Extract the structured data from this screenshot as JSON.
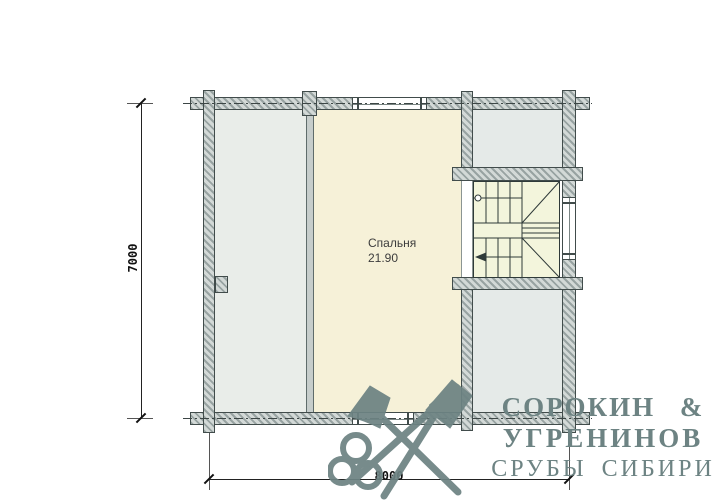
{
  "document": {
    "type": "log-house floor plan drawing",
    "floor_note": "second floor plan with bedroom and staircase"
  },
  "plan": {
    "room_label": {
      "name": "Спальня",
      "area": "21.90"
    },
    "features": [
      "stairs",
      "window-top",
      "window-bottom",
      "window-right",
      "stair-opening"
    ]
  },
  "dimensions": {
    "vertical": "7000",
    "horizontal": "8000"
  },
  "logo": {
    "line1": "СОРОКИН &",
    "line2": "УГРЕНИНОВ",
    "line3": "СРУБЫ СИБИРИ",
    "mark_icon": "crossed-axes-key-icon"
  },
  "colors": {
    "wall_hatch_dark": "#98a3a2",
    "wall_hatch_light": "#d3d9d7",
    "wall_outline": "#414c4b",
    "room_left_fill": "#e9ede9",
    "room_right_fill": "#e5eae8",
    "bedroom_fill": "#f6f1d8",
    "stairs_fill": "#f3f5dc",
    "logo_color": "#6d8383",
    "dimension_color": "#111111",
    "label_color": "#3c3c3c",
    "background": "#ffffff"
  }
}
